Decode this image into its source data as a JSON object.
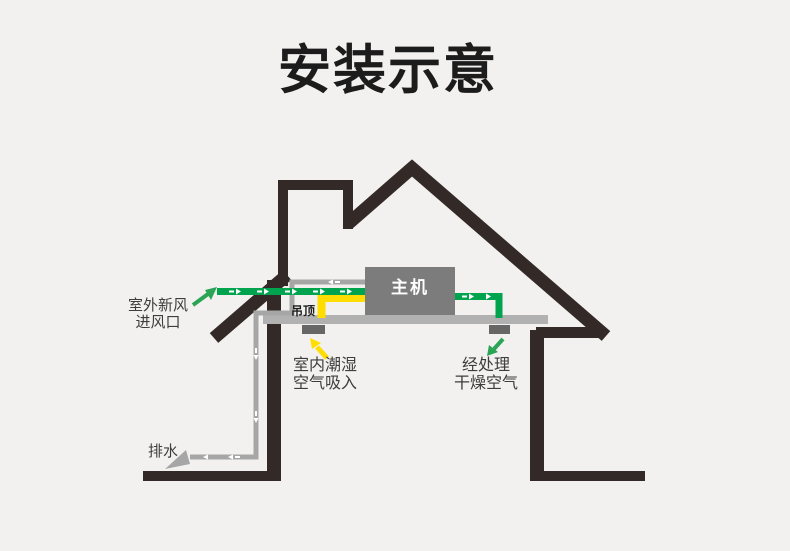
{
  "title": "安装示意",
  "labels": {
    "outdoor_fresh_air_line1": "室外新风",
    "outdoor_fresh_air_line2": "进风口",
    "ceiling": "吊顶",
    "main_unit": "主机",
    "indoor_humid_line1": "室内潮湿",
    "indoor_humid_line2": "空气吸入",
    "treated_dry_line1": "经处理",
    "treated_dry_line2": "干燥空气",
    "drain": "排水"
  },
  "colors": {
    "background": "#f2f1ef",
    "house_outline": "#332a27",
    "ceiling": "#b1b1b1",
    "main_unit": "#7c7c7c",
    "vent": "#666666",
    "drain_pipe": "#a6a6a6",
    "fresh_air_duct": "#00a44f",
    "fresh_air_arrow": "#2ba455",
    "humid_air_duct": "#ffdd00",
    "flow_mark": "#ffffff",
    "title_text": "#1c1c1c",
    "label_text": "#3d3d3d"
  }
}
